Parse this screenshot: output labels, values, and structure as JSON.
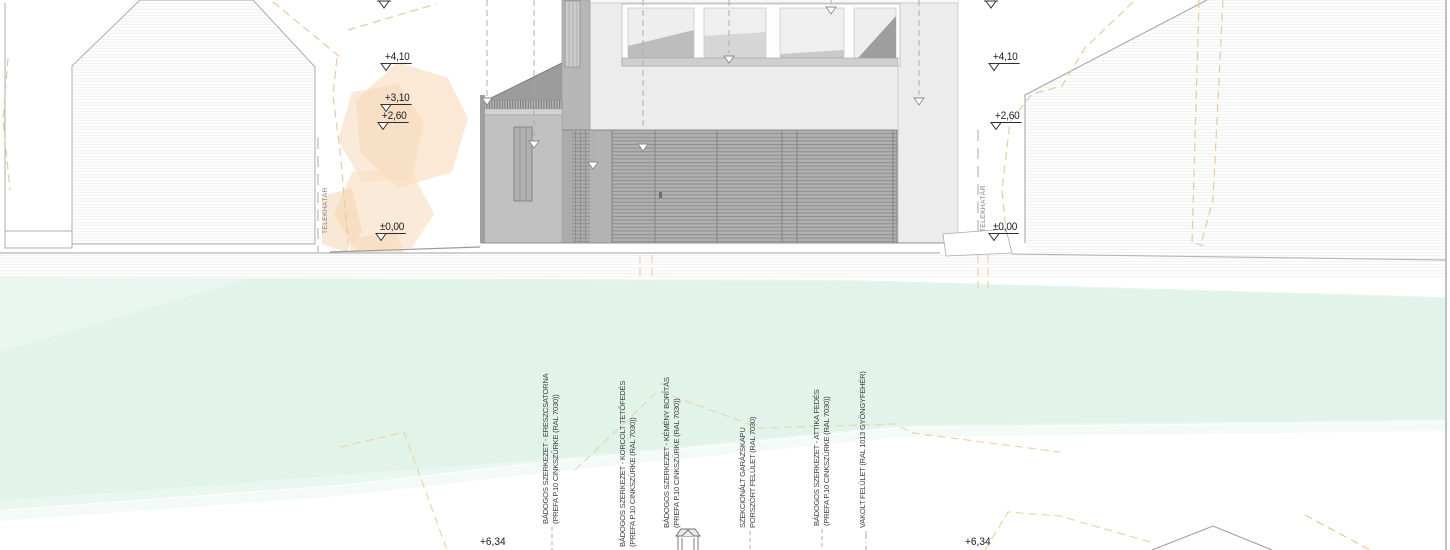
{
  "drawing_type": "architectural elevation",
  "markers": {
    "left": [
      {
        "label": "+4,10"
      },
      {
        "label": "+3,10"
      },
      {
        "label": "+2,60"
      },
      {
        "label": "±0,00"
      }
    ],
    "right": [
      {
        "label": "+4,10"
      },
      {
        "label": "+2,60"
      },
      {
        "label": "±0,00"
      }
    ],
    "bottom": [
      {
        "label": "+6,34"
      },
      {
        "label": "+6,34"
      }
    ]
  },
  "boundary": {
    "left_label": "TELEKHATÁR",
    "right_label": "TELEKHATÁR"
  },
  "annotations": [
    {
      "line1": "BÁDOGOS SZERKEZET - ERESZCSATORNA",
      "line2": "(PREFA P.10 CINKSZÜRKE (RAL 7030))"
    },
    {
      "line1": "BÁDOGOS SZERKEZET - KORCOLT TETŐFEDÉS",
      "line2": "(PREFA P.10 CINKSZÜRKE (RAL 7030))"
    },
    {
      "line1": "BÁDOGOS SZERKEZET - KÉMÉNY BORÍTÁS",
      "line2": "(PREFA P.10 CINKSZÜRKE (RAL 7030))"
    },
    {
      "line1": "SZEKCIONÁLT GARÁZSKAPU",
      "line2": "PORSZÓRT FELÜLET (RAL 7030)"
    },
    {
      "line1": "BÁDOGOS SZERKEZET - ATTIKA FEDÉS",
      "line2": "(PREFA P.10 CINKSZÜRKE (RAL 7030))"
    },
    {
      "line1": "VAKOLT FELÜLET (RAL 1013 GYÖNGYFEHÉR)",
      "line2": ""
    }
  ],
  "colors": {
    "facade_light": "#ececec",
    "facade_mid": "#b5b5b5",
    "louver": "#b0b0b0",
    "tree_fill": "#f9dfc3",
    "boundary_dash": "#e6cba4",
    "green_zone": "#e6f5ee",
    "marker_text": "#1c1c1c",
    "leader_gray": "#9a9a9a"
  }
}
